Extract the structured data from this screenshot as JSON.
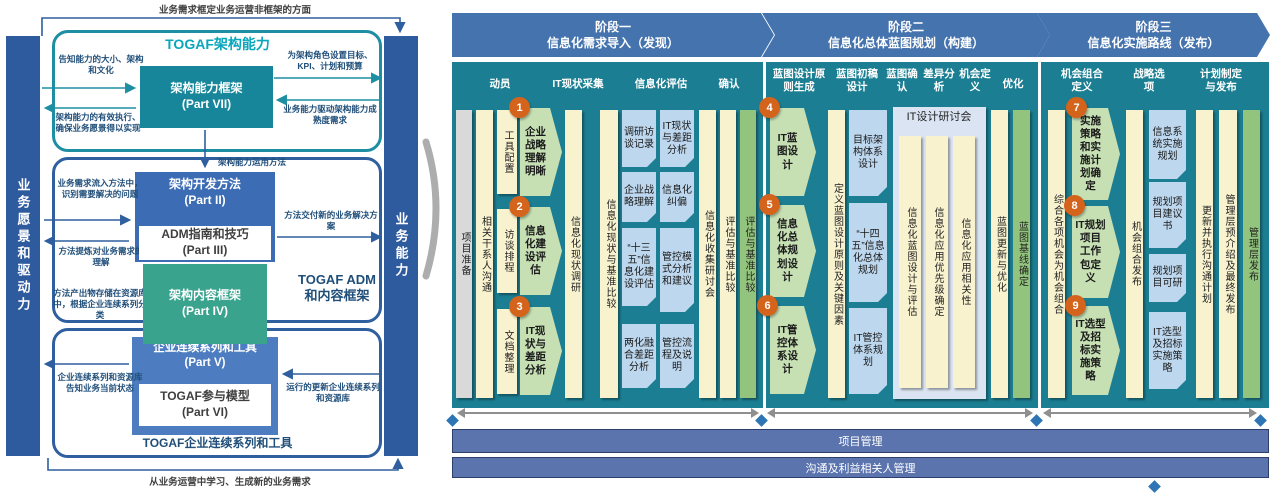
{
  "colors": {
    "teal_panel": "#1b7e92",
    "header_blue": "#4573ae",
    "bottom_bar": "#5b74ae",
    "navy_bar": "#2e5a9e",
    "teal_border": "#1e8fa3",
    "blue_border": "#2f5f9e",
    "part7_box": "#17869a",
    "part2_box": "#3c6cb4",
    "part4_box": "#3aa38d",
    "part5_box": "#4d7dc0",
    "yellow_col": "#f8f2cf",
    "green_col": "#93c47d",
    "step_green": "#c6e0b4",
    "card_blue": "#bdd7ee",
    "lavender": "#dbe4f2",
    "orange_badge": "#d4631c",
    "diamond": "#2e75b6"
  },
  "togaf": {
    "top_note": "业务需求框定业务运营非框架的方面",
    "bottom_note": "从业务运营中学习、生成新的业务需求",
    "left_bar": "业务愿景和驱动力",
    "right_bar": "业务能力",
    "cap_title": "TOGAF架构能力",
    "part7": "架构能力框架",
    "part7p": "(Part VII)",
    "ann_tl": "告知能力的大小、架构和文化",
    "ann_tr": "为架构角色设置目标、KPI、计划和预算",
    "ann_bl": "架构能力的有效执行、确保业务愿景得以实现",
    "ann_br": "业务能力驱动架构能力成熟度需求",
    "link_label": "架构能力运用方法",
    "part2": "架构开发方法",
    "part2p": "(Part II)",
    "part3": "ADM指南和技巧",
    "part3p": "(Part III)",
    "part4": "架构内容框架",
    "part4p": "(Part IV)",
    "part5": "企业连续系列和工具",
    "part5p": "(Part V)",
    "part6": "TOGAF参与模型",
    "part6p": "(Part VI)",
    "ann_l1": "业务需求流入方法中，识别需要解决的问题",
    "ann_r1": "方法交付新的业务解决方案",
    "ann_l2": "方法提炼对业务需求的理解",
    "adm_label": "TOGAF ADM和内容框架",
    "ann_l3": "方法产出物存储在资源库中，根据企业连续系列分类",
    "ann_l4": "企业连续系列和资源库告知业务当前状态",
    "ann_r2": "运行的更新企业连续系列和资源库",
    "cont_label": "TOGAF企业连续系列和工具"
  },
  "p1": {
    "t1": "阶段一",
    "t2": "信息化需求导入（发现）",
    "headers": [
      "动员",
      "IT现状采集",
      "信息化评估",
      "确认"
    ],
    "prep": "项目准备",
    "comm": "相关干系人沟通",
    "tasks": [
      "工具配置",
      "访谈排程",
      "文档整理"
    ],
    "steps": [
      {
        "n": "1",
        "label": "企业战略理解明晰"
      },
      {
        "n": "2",
        "label": "信息化建设评估"
      },
      {
        "n": "3",
        "label": "IT现状与差距分析"
      }
    ],
    "survey": "信息化现状调研",
    "baseline": "信息化现状与基准比较",
    "cardsA": [
      "调研访谈记录",
      "企业战略理解",
      "“十三五”信息化建设评估",
      "两化融合差距分析"
    ],
    "cardsB": [
      "IT现状与差距分析",
      "信息化纠偏",
      "管控模式分析和建议",
      "管控流程及说明"
    ],
    "workshop": "信息化收集研讨会",
    "compare": "评估与基准比较",
    "compare_green": "评估与基准比较"
  },
  "p2": {
    "t1": "阶段二",
    "t2": "信息化总体蓝图规划（构建）",
    "headers": [
      "蓝图设计原则生成",
      "蓝图初稿设计",
      "蓝图确认",
      "差异分析",
      "机会定义",
      "优化"
    ],
    "steps": [
      {
        "n": "4",
        "label": "IT蓝图设计"
      },
      {
        "n": "5",
        "label": "信息化总体规划设计"
      },
      {
        "n": "6",
        "label": "IT管控体系设计"
      }
    ],
    "principles": "定义蓝图设计原则及关键因素",
    "cards": [
      "目标架构体系设计",
      "“十四五”信息化总体规划",
      "IT管控体系规划"
    ],
    "workshop_title": "IT设计研讨会",
    "workshop_cols": [
      "信息化蓝图设计与评估",
      "信息化应用优先级确定",
      "信息化应用相关性"
    ],
    "update": "蓝图更新与优化",
    "baseline_green": "蓝图基线确定"
  },
  "p3": {
    "t1": "阶段三",
    "t2": "信息化实施路线（发布）",
    "headers": [
      "机会组合定义",
      "战略选项",
      "计划制定与发布"
    ],
    "combine": "综合各项机会为机会组合",
    "steps": [
      {
        "n": "7",
        "label": "实施策略和实施计划确定"
      },
      {
        "n": "8",
        "label": "IT规划项目工作包定义"
      },
      {
        "n": "9",
        "label": "IT选型及招标实施策略"
      }
    ],
    "publish": "机会组合发布",
    "cards": [
      "信息系统实施规划",
      "规划项目建议书",
      "规划项目可研",
      "IT选型及招标实施策略"
    ],
    "comm_plan": "更新并执行沟通计划",
    "mgmt_intro": "管理层预介绍及最终发布",
    "mgmt_release": "管理层发布"
  },
  "bottom": {
    "bar1": "项目管理",
    "bar2": "沟通及利益相关人管理"
  }
}
